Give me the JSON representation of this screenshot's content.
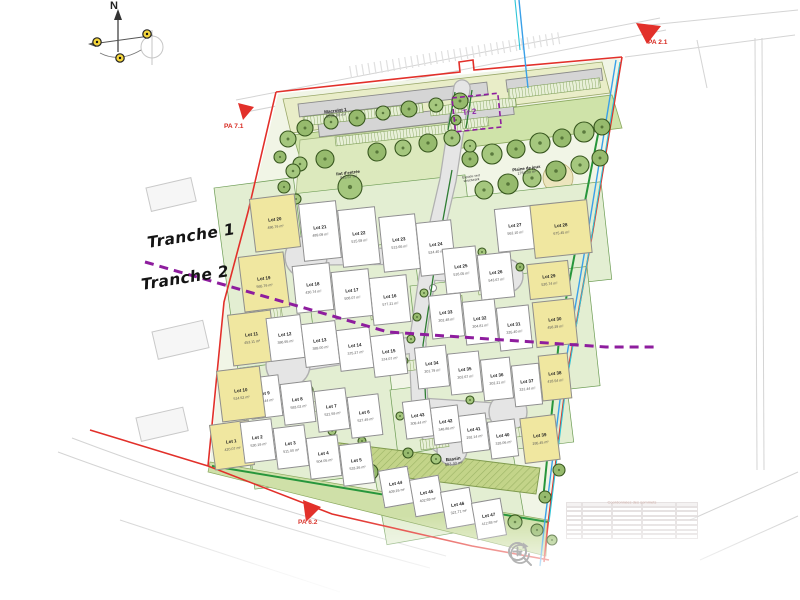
{
  "viewer": {
    "controls": [
      {
        "id": "zoom-in",
        "icon": "magnifier-plus-icon"
      },
      {
        "id": "zoom-out",
        "icon": "magnifier-minus-icon"
      },
      {
        "id": "search",
        "icon": "magnifier-icon"
      },
      {
        "id": "reset-rotation",
        "icon": "rotate-arrow-icon"
      }
    ]
  },
  "labels": {
    "north": "N",
    "tranche1": "Tranche 1",
    "tranche2": "Tranche 2",
    "pa_top_right": "PA 2.1",
    "pa_left": "PA 7.1",
    "pa_bottom_left": "PA 6.2",
    "tr2": "Tr 2",
    "macrolot": {
      "name": "Macrolot 1",
      "area": "3096.00 m²"
    },
    "ilot_entree": {
      "name": "Ilot d'entrée",
      "area": "845.67 m²"
    },
    "espace_vert": {
      "line1": "Espace vert",
      "line2": "structurant"
    },
    "plaine_de_jeux": {
      "name": "Plaine de jeux",
      "area": "1784.00 m²"
    },
    "bassin": {
      "name": "Bassin",
      "area": "583.40 m²"
    },
    "coords_table_title": "Coordonnées des sommets"
  },
  "colors": {
    "boundary_red": "#e2302a",
    "tranche_purple": "#8e1d9e",
    "water_blue": "#3aa0e8",
    "utility_cyan": "#2cc5d8",
    "hedge_green": "#2e7d32",
    "bright_green": "#27963c",
    "lot_yellow": "#f0e7a0",
    "tree_green": "#96ba6d"
  },
  "lots": [
    {
      "label": "Lot 1",
      "area": "420.07 m²",
      "x": 212,
      "y": 422,
      "w": 40,
      "h": 46,
      "rot": -8,
      "fill": "yellow"
    },
    {
      "label": "Lot 2",
      "area": "530.19 m²",
      "x": 242,
      "y": 420,
      "w": 32,
      "h": 42,
      "rot": -7,
      "fill": "white"
    },
    {
      "label": "Lot 3",
      "area": "511.00 m²",
      "x": 275,
      "y": 426,
      "w": 32,
      "h": 42,
      "rot": -7,
      "fill": "white"
    },
    {
      "label": "Lot 4",
      "area": "504.05 m²",
      "x": 308,
      "y": 436,
      "w": 32,
      "h": 42,
      "rot": -7,
      "fill": "white"
    },
    {
      "label": "Lot 5",
      "area": "533.26 m²",
      "x": 341,
      "y": 443,
      "w": 32,
      "h": 42,
      "rot": -7,
      "fill": "white"
    },
    {
      "label": "Lot 6",
      "area": "527.49 m²",
      "x": 349,
      "y": 395,
      "w": 32,
      "h": 42,
      "rot": -7,
      "fill": "white"
    },
    {
      "label": "Lot 7",
      "area": "521.59 m²",
      "x": 316,
      "y": 389,
      "w": 32,
      "h": 42,
      "rot": -7,
      "fill": "white"
    },
    {
      "label": "Lot 8",
      "area": "583.02 m²",
      "x": 282,
      "y": 382,
      "w": 32,
      "h": 42,
      "rot": -7,
      "fill": "white"
    },
    {
      "label": "Lot 9",
      "area": "370.44 m²",
      "x": 249,
      "y": 376,
      "w": 32,
      "h": 42,
      "rot": -7,
      "fill": "white"
    },
    {
      "label": "Lot 10",
      "area": "514.52 m²",
      "x": 219,
      "y": 368,
      "w": 44,
      "h": 52,
      "rot": -7,
      "fill": "yellow"
    },
    {
      "label": "Lot 11",
      "area": "453.11 m²",
      "x": 230,
      "y": 312,
      "w": 44,
      "h": 52,
      "rot": -7,
      "fill": "yellow"
    },
    {
      "label": "Lot 12",
      "area": "386.95 m²",
      "x": 268,
      "y": 316,
      "w": 35,
      "h": 44,
      "rot": -7,
      "fill": "white"
    },
    {
      "label": "Lot 13",
      "area": "389.00 m²",
      "x": 303,
      "y": 322,
      "w": 35,
      "h": 44,
      "rot": -7,
      "fill": "white"
    },
    {
      "label": "Lot 14",
      "area": "375.27 m²",
      "x": 338,
      "y": 328,
      "w": 34,
      "h": 42,
      "rot": -7,
      "fill": "white"
    },
    {
      "label": "Lot 15",
      "area": "374.07 m²",
      "x": 372,
      "y": 334,
      "w": 34,
      "h": 42,
      "rot": -7,
      "fill": "white"
    },
    {
      "label": "Lot 16",
      "area": "577.21 m²",
      "x": 371,
      "y": 276,
      "w": 38,
      "h": 48,
      "rot": -6,
      "fill": "white"
    },
    {
      "label": "Lot 17",
      "area": "508.07 m²",
      "x": 333,
      "y": 270,
      "w": 38,
      "h": 48,
      "rot": -6,
      "fill": "white"
    },
    {
      "label": "Lot 18",
      "area": "430.74 m²",
      "x": 294,
      "y": 264,
      "w": 38,
      "h": 48,
      "rot": -6,
      "fill": "white"
    },
    {
      "label": "Lot 19",
      "area": "565.79 m²",
      "x": 241,
      "y": 254,
      "w": 46,
      "h": 56,
      "rot": -7,
      "fill": "yellow"
    },
    {
      "label": "Lot 20",
      "area": "486.79 m²",
      "x": 252,
      "y": 196,
      "w": 46,
      "h": 54,
      "rot": -7,
      "fill": "yellow"
    },
    {
      "label": "Lot 21",
      "area": "489.09 m²",
      "x": 301,
      "y": 202,
      "w": 38,
      "h": 58,
      "rot": -6,
      "fill": "white"
    },
    {
      "label": "Lot 22",
      "area": "515.59 m²",
      "x": 340,
      "y": 208,
      "w": 38,
      "h": 58,
      "rot": -6,
      "fill": "white"
    },
    {
      "label": "Lot 23",
      "area": "513.66 m²",
      "x": 381,
      "y": 215,
      "w": 37,
      "h": 56,
      "rot": -6,
      "fill": "white"
    },
    {
      "label": "Lot 24",
      "area": "524.40 m²",
      "x": 418,
      "y": 221,
      "w": 36,
      "h": 54,
      "rot": -6,
      "fill": "white"
    },
    {
      "label": "Lot 25",
      "area": "516.05 m²",
      "x": 444,
      "y": 247,
      "w": 34,
      "h": 46,
      "rot": -6,
      "fill": "white"
    },
    {
      "label": "Lot 26",
      "area": "543.67 m²",
      "x": 479,
      "y": 253,
      "w": 34,
      "h": 46,
      "rot": -6,
      "fill": "white"
    },
    {
      "label": "Lot 27",
      "area": "562.10 m²",
      "x": 496,
      "y": 207,
      "w": 38,
      "h": 44,
      "rot": -6,
      "fill": "white"
    },
    {
      "label": "Lot 28",
      "area": "675.45 m²",
      "x": 532,
      "y": 202,
      "w": 58,
      "h": 54,
      "rot": -6,
      "fill": "yellow"
    },
    {
      "label": "Lot 29",
      "area": "526.74 m²",
      "x": 528,
      "y": 262,
      "w": 42,
      "h": 36,
      "rot": -6,
      "fill": "yellow"
    },
    {
      "label": "Lot 30",
      "area": "458.29 m²",
      "x": 534,
      "y": 300,
      "w": 42,
      "h": 46,
      "rot": -6,
      "fill": "yellow"
    },
    {
      "label": "Lot 31",
      "area": "335.40 m²",
      "x": 498,
      "y": 306,
      "w": 33,
      "h": 44,
      "rot": -6,
      "fill": "white"
    },
    {
      "label": "Lot 32",
      "area": "304.81 m²",
      "x": 464,
      "y": 300,
      "w": 33,
      "h": 44,
      "rot": -6,
      "fill": "white"
    },
    {
      "label": "Lot 33",
      "area": "302.48 m²",
      "x": 430,
      "y": 294,
      "w": 33,
      "h": 44,
      "rot": -6,
      "fill": "white"
    },
    {
      "label": "Lot 34",
      "area": "301.79 m²",
      "x": 416,
      "y": 346,
      "w": 32,
      "h": 42,
      "rot": -6,
      "fill": "white"
    },
    {
      "label": "Lot 35",
      "area": "302.67 m²",
      "x": 449,
      "y": 352,
      "w": 32,
      "h": 42,
      "rot": -6,
      "fill": "white"
    },
    {
      "label": "Lot 36",
      "area": "302.21 m²",
      "x": 482,
      "y": 358,
      "w": 30,
      "h": 42,
      "rot": -6,
      "fill": "white"
    },
    {
      "label": "Lot 37",
      "area": "331.44 m²",
      "x": 513,
      "y": 364,
      "w": 28,
      "h": 42,
      "rot": -6,
      "fill": "white"
    },
    {
      "label": "Lot 38",
      "area": "418.54 m²",
      "x": 540,
      "y": 354,
      "w": 30,
      "h": 46,
      "rot": -6,
      "fill": "yellow"
    },
    {
      "label": "Lot 39",
      "area": "295.45 m²",
      "x": 522,
      "y": 416,
      "w": 36,
      "h": 46,
      "rot": -7,
      "fill": "yellow"
    },
    {
      "label": "Lot 40",
      "area": "318.06 m²",
      "x": 489,
      "y": 420,
      "w": 28,
      "h": 38,
      "rot": -7,
      "fill": "white"
    },
    {
      "label": "Lot 41",
      "area": "292.14 m²",
      "x": 460,
      "y": 414,
      "w": 28,
      "h": 38,
      "rot": -7,
      "fill": "white"
    },
    {
      "label": "Lot 42",
      "area": "348.86 m²",
      "x": 432,
      "y": 406,
      "w": 28,
      "h": 38,
      "rot": -7,
      "fill": "white"
    },
    {
      "label": "Lot 43",
      "area": "309.44 m²",
      "x": 404,
      "y": 400,
      "w": 28,
      "h": 38,
      "rot": -7,
      "fill": "white"
    },
    {
      "label": "Lot 44",
      "area": "409.16 m²",
      "x": 381,
      "y": 468,
      "w": 30,
      "h": 38,
      "rot": -10,
      "fill": "white"
    },
    {
      "label": "Lot 45",
      "area": "402.69 m²",
      "x": 412,
      "y": 477,
      "w": 30,
      "h": 38,
      "rot": -10,
      "fill": "white"
    },
    {
      "label": "Lot 46",
      "area": "321.71 m²",
      "x": 443,
      "y": 489,
      "w": 30,
      "h": 38,
      "rot": -10,
      "fill": "white"
    },
    {
      "label": "Lot 47",
      "area": "412.88 m²",
      "x": 474,
      "y": 500,
      "w": 30,
      "h": 38,
      "rot": -10,
      "fill": "white"
    }
  ]
}
